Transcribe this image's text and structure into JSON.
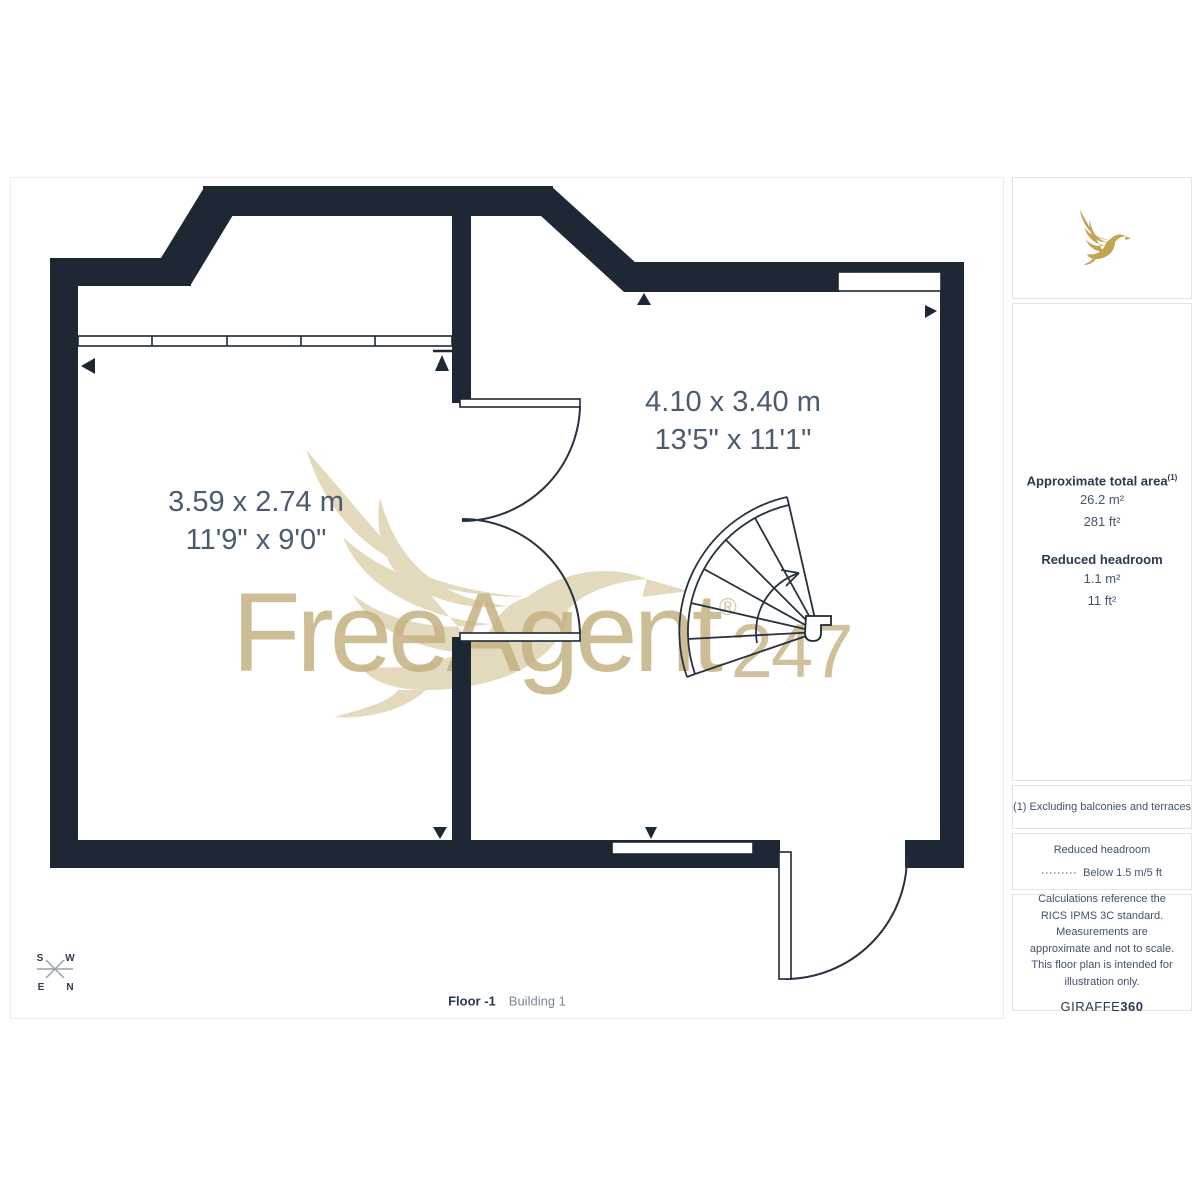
{
  "colors": {
    "wall": "#1e2834",
    "plan_line": "#27313f",
    "gold_logo": "#c3a453",
    "watermark_gold": "#c5b283",
    "room_label": "#4b5b70",
    "heading_text": "#2b3a4f",
    "compass_line": "#98a0a9"
  },
  "watermark": {
    "text": "FreeAgent",
    "registered": "®",
    "suffix": "247"
  },
  "rooms": [
    {
      "metric": "3.59 x 2.74 m",
      "imperial": "11'9\" x 9'0\""
    },
    {
      "metric": "4.10 x 3.40 m",
      "imperial": "13'5\" x 11'1\""
    }
  ],
  "sidebar": {
    "area_heading": "Approximate total area",
    "area_sup": "(1)",
    "area_metric": "26.2 m²",
    "area_imperial": "281 ft²",
    "headroom_heading": "Reduced headroom",
    "headroom_metric": "1.1 m²",
    "headroom_imperial": "11 ft²",
    "footnote": "(1) Excluding balconies and terraces",
    "legend_heading": "Reduced headroom",
    "legend_label": "Below 1.5 m/5 ft",
    "disclaimer": "Calculations reference the RICS IPMS 3C standard. Measurements are approximate and not to scale. This floor plan is intended for illustration only.",
    "brand_name": "GIRAFFE",
    "brand_suffix": "360"
  },
  "footer": {
    "floor": "Floor -1",
    "building": "Building 1"
  },
  "compass": {
    "top_left": "S",
    "top_right": "W",
    "bottom_left": "E",
    "bottom_right": "N"
  }
}
